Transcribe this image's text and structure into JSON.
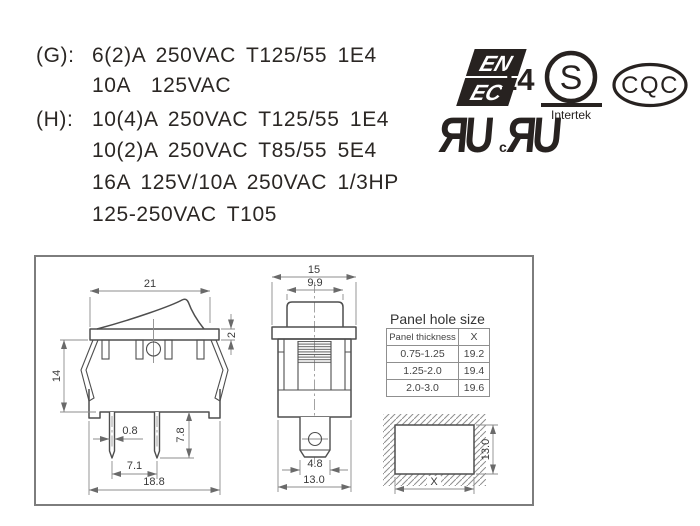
{
  "ratings": {
    "rows": [
      {
        "label": "(G):",
        "text": "6(2)A 250VAC T125/55 1E4"
      },
      {
        "label": "",
        "text": "10A  125VAC"
      },
      {
        "label": "(H):",
        "text": "10(4)A 250VAC T125/55 1E4"
      },
      {
        "label": "",
        "text": "10(2)A 250VAC T85/55 5E4"
      },
      {
        "label": "",
        "text": "16A 125V/10A 250VAC 1/3HP"
      },
      {
        "label": "",
        "text": "125-250VAC T105"
      }
    ]
  },
  "certifications": {
    "enec": {
      "line1": "EN",
      "line2": "EC",
      "number": "14"
    },
    "intertek": {
      "letter": "S",
      "name": "Intertek"
    },
    "ul": {
      "mark1": "ЯU",
      "c": "c",
      "mark2": "ЯU"
    },
    "cqc": {
      "label": "CQC"
    }
  },
  "drawings": {
    "side_view": {
      "dim_top_width": "21",
      "dim_flange_height": "2",
      "dim_body_height": "14",
      "dim_pin_width": "0.8",
      "dim_pin_length": "7.8",
      "dim_pin_pitch": "7.1",
      "dim_base_width": "18.8"
    },
    "front_view": {
      "dim_top_width": "15",
      "dim_rocker_width": "9.9",
      "dim_terminal_width": "4.8",
      "dim_body_width": "13.0"
    },
    "panel_table": {
      "title": "Panel hole size",
      "col1_header": "Panel thickness",
      "col2_header": "X",
      "rows": [
        {
          "thickness": "0.75-1.25",
          "x": "19.2"
        },
        {
          "thickness": "1.25-2.0",
          "x": "19.4"
        },
        {
          "thickness": "2.0-3.0",
          "x": "19.6"
        }
      ]
    },
    "cutout": {
      "dim_width": "X",
      "dim_height": "13.0"
    }
  },
  "colors": {
    "ink": "#272220",
    "outline": "#4e4e4e",
    "dim_line": "#8c8c8c"
  }
}
